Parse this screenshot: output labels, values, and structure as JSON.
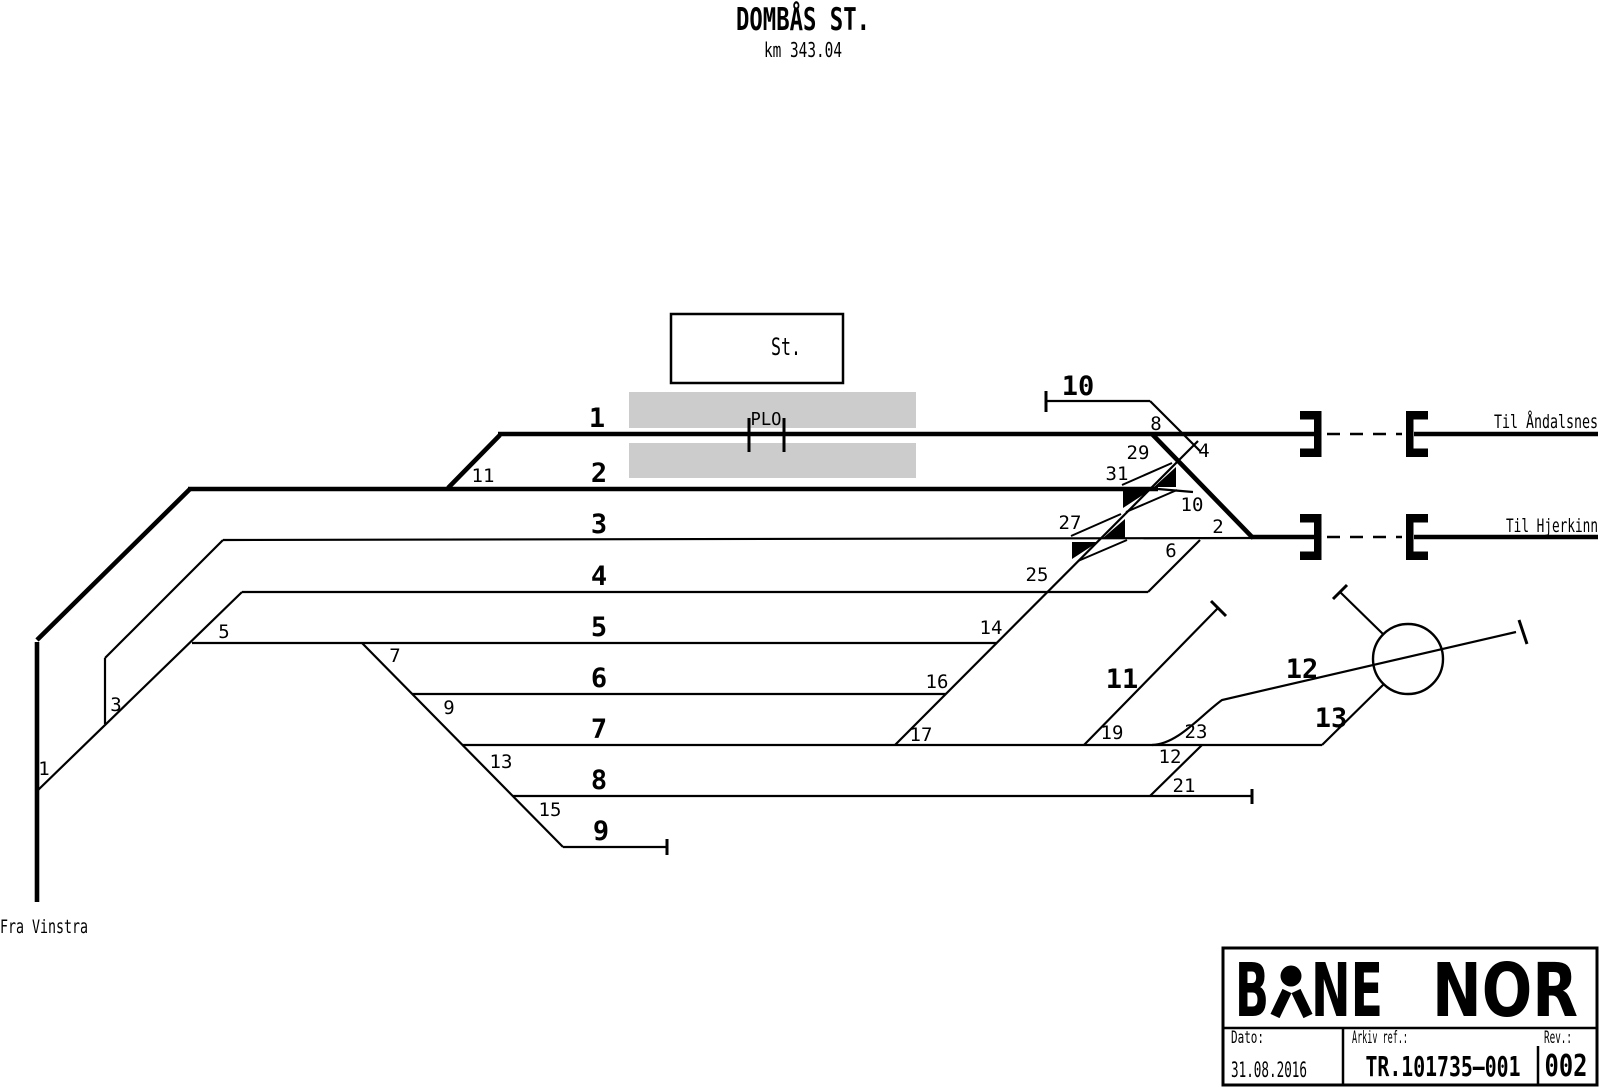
{
  "page": {
    "background": "#ffffff",
    "line_color": "#000000",
    "platform_color": "#cccccc"
  },
  "header": {
    "title": "DOMBÅS ST.",
    "km": "km 343.04"
  },
  "station": {
    "box_label": "St.",
    "plo_label": "PLO"
  },
  "endpoints": {
    "andalsnes": "Til Åndalsnes",
    "hjerkinn": "Til Hjerkinn",
    "vinstra": "Fra Vinstra"
  },
  "tracks": {
    "t1": "1",
    "t2": "2",
    "t3": "3",
    "t4": "4",
    "t5": "5",
    "t6": "6",
    "t7": "7",
    "t8": "8",
    "t9": "9",
    "t10": "10",
    "t11": "11",
    "t12": "12",
    "t13": "13"
  },
  "switches": {
    "s1": "1",
    "s2": "2",
    "s3": "3",
    "s4": "4",
    "s5": "5",
    "s6": "6",
    "s7": "7",
    "s8": "8",
    "s9": "9",
    "s10": "10",
    "s11": "11",
    "s12": "12",
    "s13": "13",
    "s14": "14",
    "s15": "15",
    "s16": "16",
    "s17": "17",
    "s19": "19",
    "s21": "21",
    "s23": "23",
    "s25": "25",
    "s27": "27",
    "s29": "29",
    "s31": "31"
  },
  "titleblock": {
    "brand_b": "B",
    "brand_ne": "NE",
    "brand_nor": "NOR",
    "date_label": "Dato:",
    "date_value": "31.08.2016",
    "ref_label": "Arkiv ref.:",
    "ref_value": "TR.101735–001",
    "rev_label": "Rev.:",
    "rev_value": "002"
  }
}
